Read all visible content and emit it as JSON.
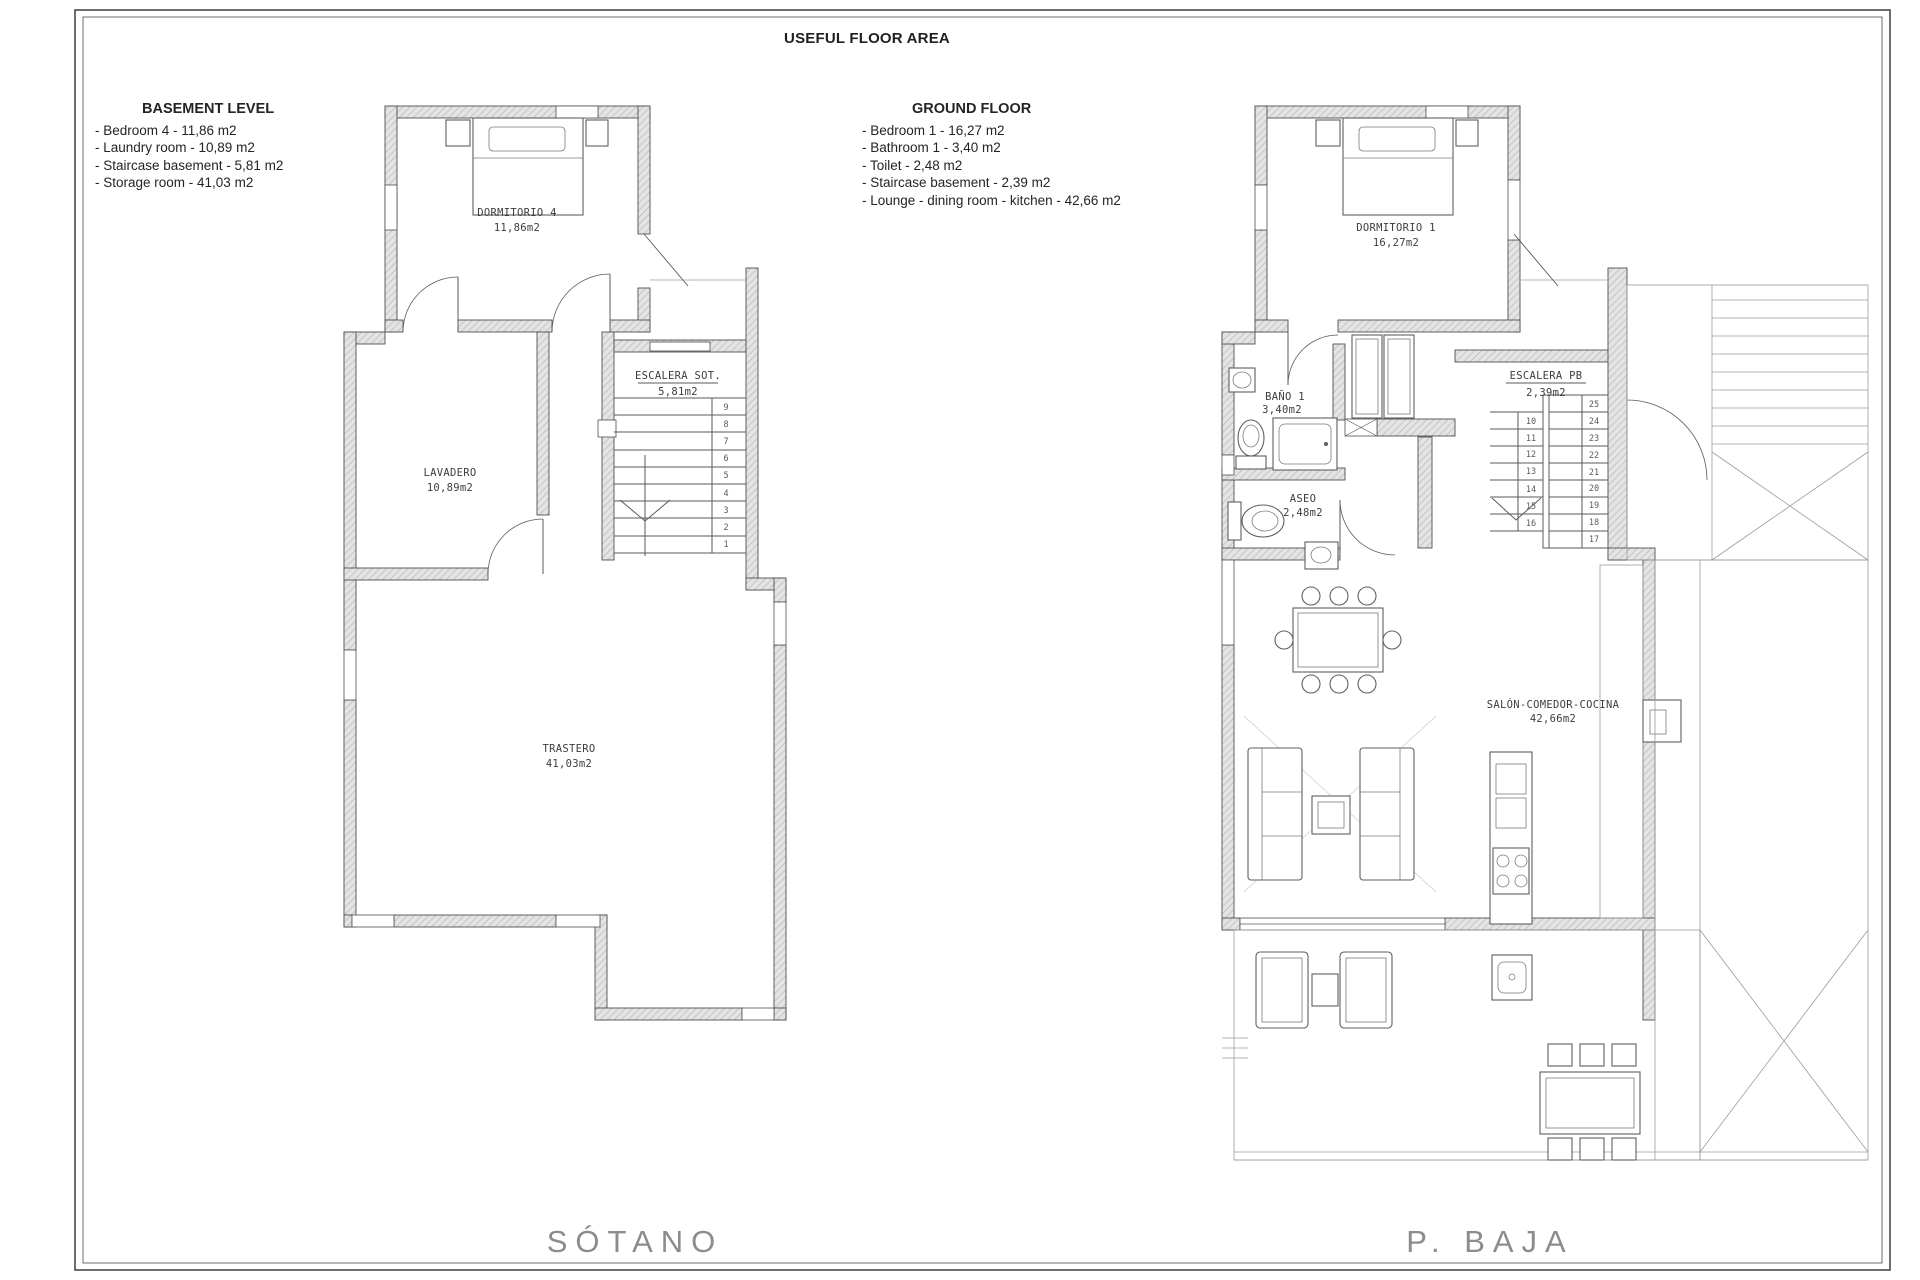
{
  "title": "USEFUL FLOOR AREA",
  "legend_basement": {
    "heading": "BASEMENT LEVEL",
    "items": [
      "- Bedroom 4 - 11,86 m2",
      "- Laundry room - 10,89 m2",
      "- Staircase basement - 5,81 m2",
      "- Storage room - 41,03 m2"
    ]
  },
  "legend_ground": {
    "heading": "GROUND FLOOR",
    "items": [
      "- Bedroom 1 - 16,27 m2",
      "- Bathroom 1 - 3,40 m2",
      "- Toilet - 2,48 m2",
      "- Staircase basement - 2,39 m2",
      "- Lounge - dining room - kitchen - 42,66 m2"
    ]
  },
  "basement": {
    "caption": "SÓTANO",
    "rooms": {
      "bedroom": {
        "name": "DORMITORIO 4",
        "area": "11,86m2"
      },
      "laundry": {
        "name": "LAVADERO",
        "area": "10,89m2"
      },
      "staircase": {
        "name": "ESCALERA SOT.",
        "area": "5,81m2"
      },
      "storage": {
        "name": "TRASTERO",
        "area": "41,03m2"
      }
    },
    "stair_numbers": [
      "9",
      "8",
      "7",
      "6",
      "5",
      "4",
      "3",
      "2",
      "1"
    ]
  },
  "ground": {
    "caption": "P. BAJA",
    "rooms": {
      "bedroom": {
        "name": "DORMITORIO 1",
        "area": "16,27m2"
      },
      "bathroom": {
        "name": "BAÑO 1",
        "area": "3,40m2"
      },
      "toilet": {
        "name": "ASEO",
        "area": "2,48m2"
      },
      "staircase": {
        "name": "ESCALERA PB",
        "area": "2,39m2"
      },
      "lounge": {
        "name": "SALÓN-COMEDOR-COCINA",
        "area": "42,66m2"
      }
    },
    "stair_numbers_left": [
      "10",
      "11",
      "12",
      "13",
      "14",
      "15",
      "16"
    ],
    "stair_numbers_right": [
      "25",
      "24",
      "23",
      "22",
      "21",
      "20",
      "19",
      "18",
      "17"
    ]
  }
}
